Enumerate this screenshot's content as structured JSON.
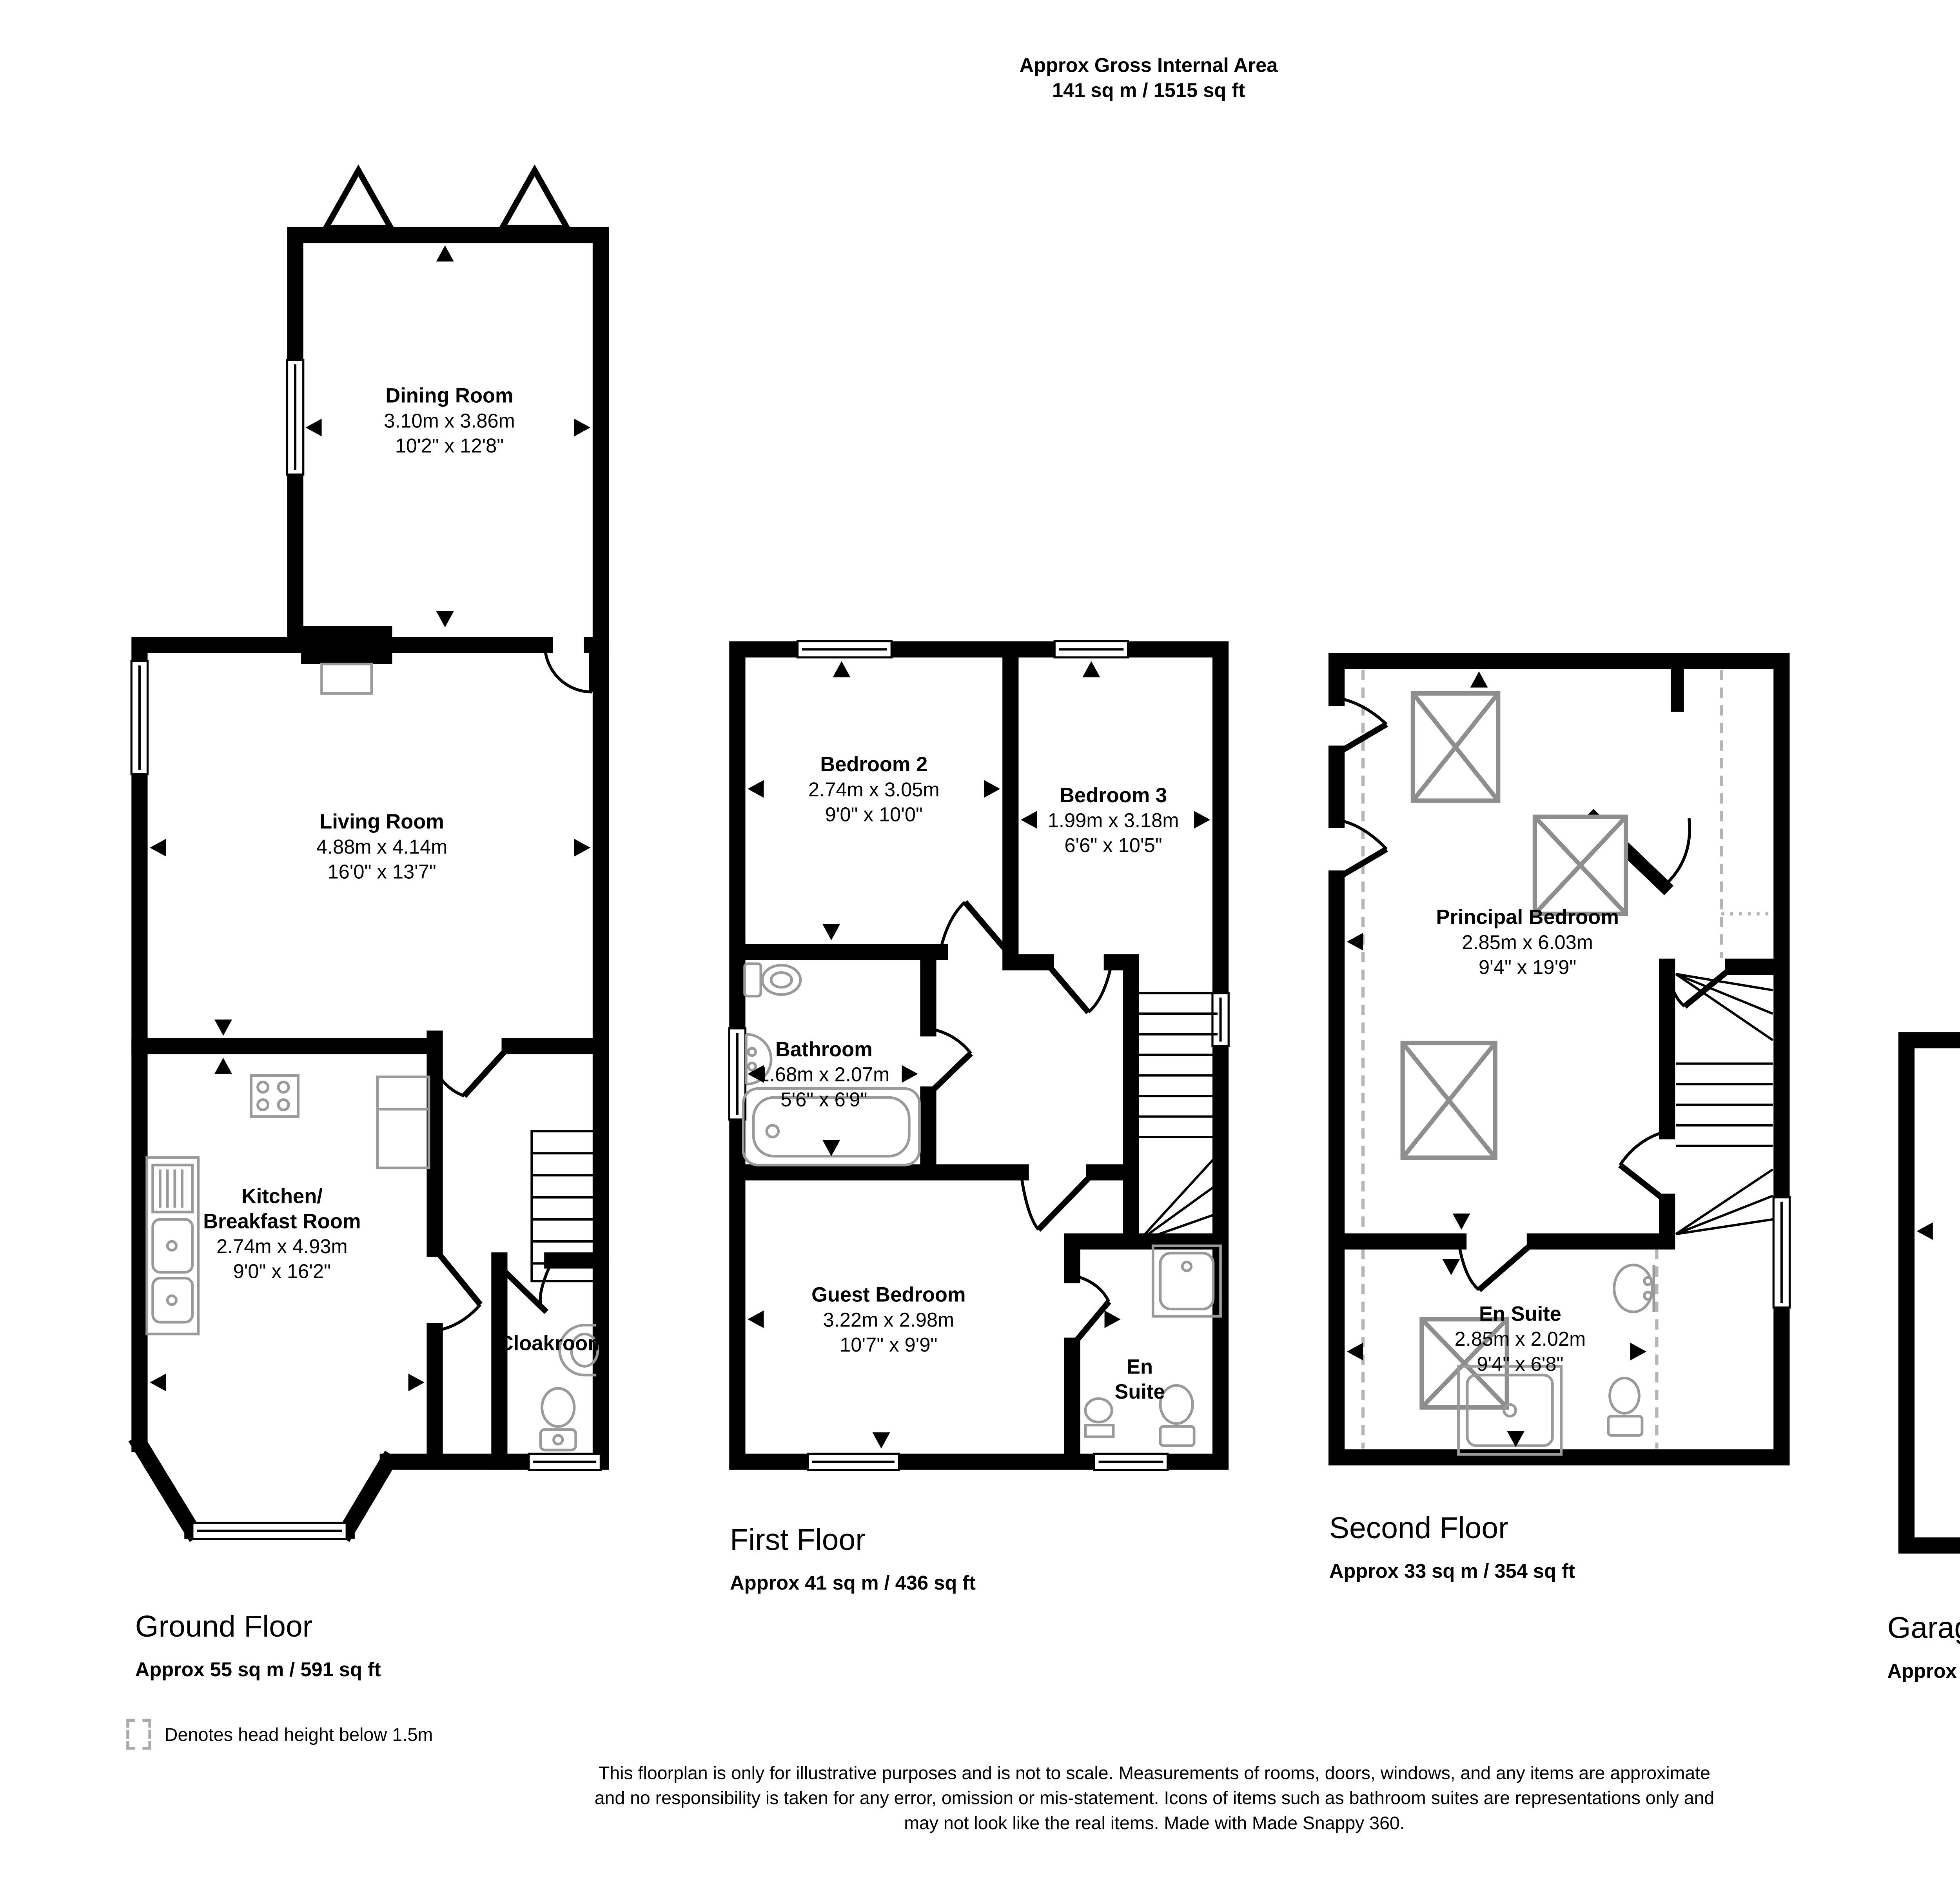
{
  "title": {
    "line1": "Approx Gross Internal Area",
    "line2": "141 sq m / 1515 sq ft"
  },
  "floors": {
    "ground": {
      "label": "Ground Floor",
      "area": "Approx 55 sq m / 591 sq ft",
      "rooms": {
        "dining": {
          "name": "Dining Room",
          "metric": "3.10m x 3.86m",
          "imperial": "10'2\" x 12'8\""
        },
        "living": {
          "name": "Living Room",
          "metric": "4.88m x 4.14m",
          "imperial": "16'0\" x 13'7\""
        },
        "kitchen": {
          "name_line1": "Kitchen/",
          "name_line2": "Breakfast Room",
          "metric": "2.74m x 4.93m",
          "imperial": "9'0\" x 16'2\""
        },
        "cloakroom": {
          "name": "Cloakroom"
        }
      }
    },
    "first": {
      "label": "First Floor",
      "area": "Approx 41 sq m / 436 sq ft",
      "rooms": {
        "bedroom2": {
          "name": "Bedroom 2",
          "metric": "2.74m x 3.05m",
          "imperial": "9'0\" x 10'0\""
        },
        "bedroom3": {
          "name": "Bedroom 3",
          "metric": "1.99m x 3.18m",
          "imperial": "6'6\" x 10'5\""
        },
        "bathroom": {
          "name": "Bathroom",
          "metric": "1.68m x 2.07m",
          "imperial": "5'6\" x 6'9\""
        },
        "guest": {
          "name": "Guest Bedroom",
          "metric": "3.22m x 2.98m",
          "imperial": "10'7\" x 9'9\""
        },
        "ensuite": {
          "name_line1": "En",
          "name_line2": "Suite"
        }
      }
    },
    "second": {
      "label": "Second Floor",
      "area": "Approx 33 sq m / 354 sq ft",
      "rooms": {
        "principal": {
          "name": "Principal Bedroom",
          "metric": "2.85m x 6.03m",
          "imperial": "9'4\" x 19'9\""
        },
        "ensuite": {
          "name": "En Suite",
          "metric": "2.85m x 2.02m",
          "imperial": "9'4\" x 6'8\""
        }
      }
    },
    "garage": {
      "label": "Garage",
      "area": "Approx 12 sq m / 134 sq ft",
      "rooms": {
        "garage": {
          "name": "Garage",
          "metric": "2.38m x 5.23m",
          "imperial": "7'10\" x 17'2\""
        }
      }
    }
  },
  "legend": {
    "text": "Denotes head height below 1.5m"
  },
  "footer": {
    "line1": "This floorplan is only for illustrative purposes and is not to scale. Measurements of rooms, doors, windows, and any items are approximate",
    "line2": "and no responsibility is taken for any error, omission or mis-statement. Icons of items such as bathroom suites are representations only and",
    "line3": "may not look like the real items. Made with Made Snappy 360."
  },
  "colors": {
    "wall": "#000000",
    "fixture": "#9a9a9a",
    "head_height_dash": "#b5b5b5"
  }
}
